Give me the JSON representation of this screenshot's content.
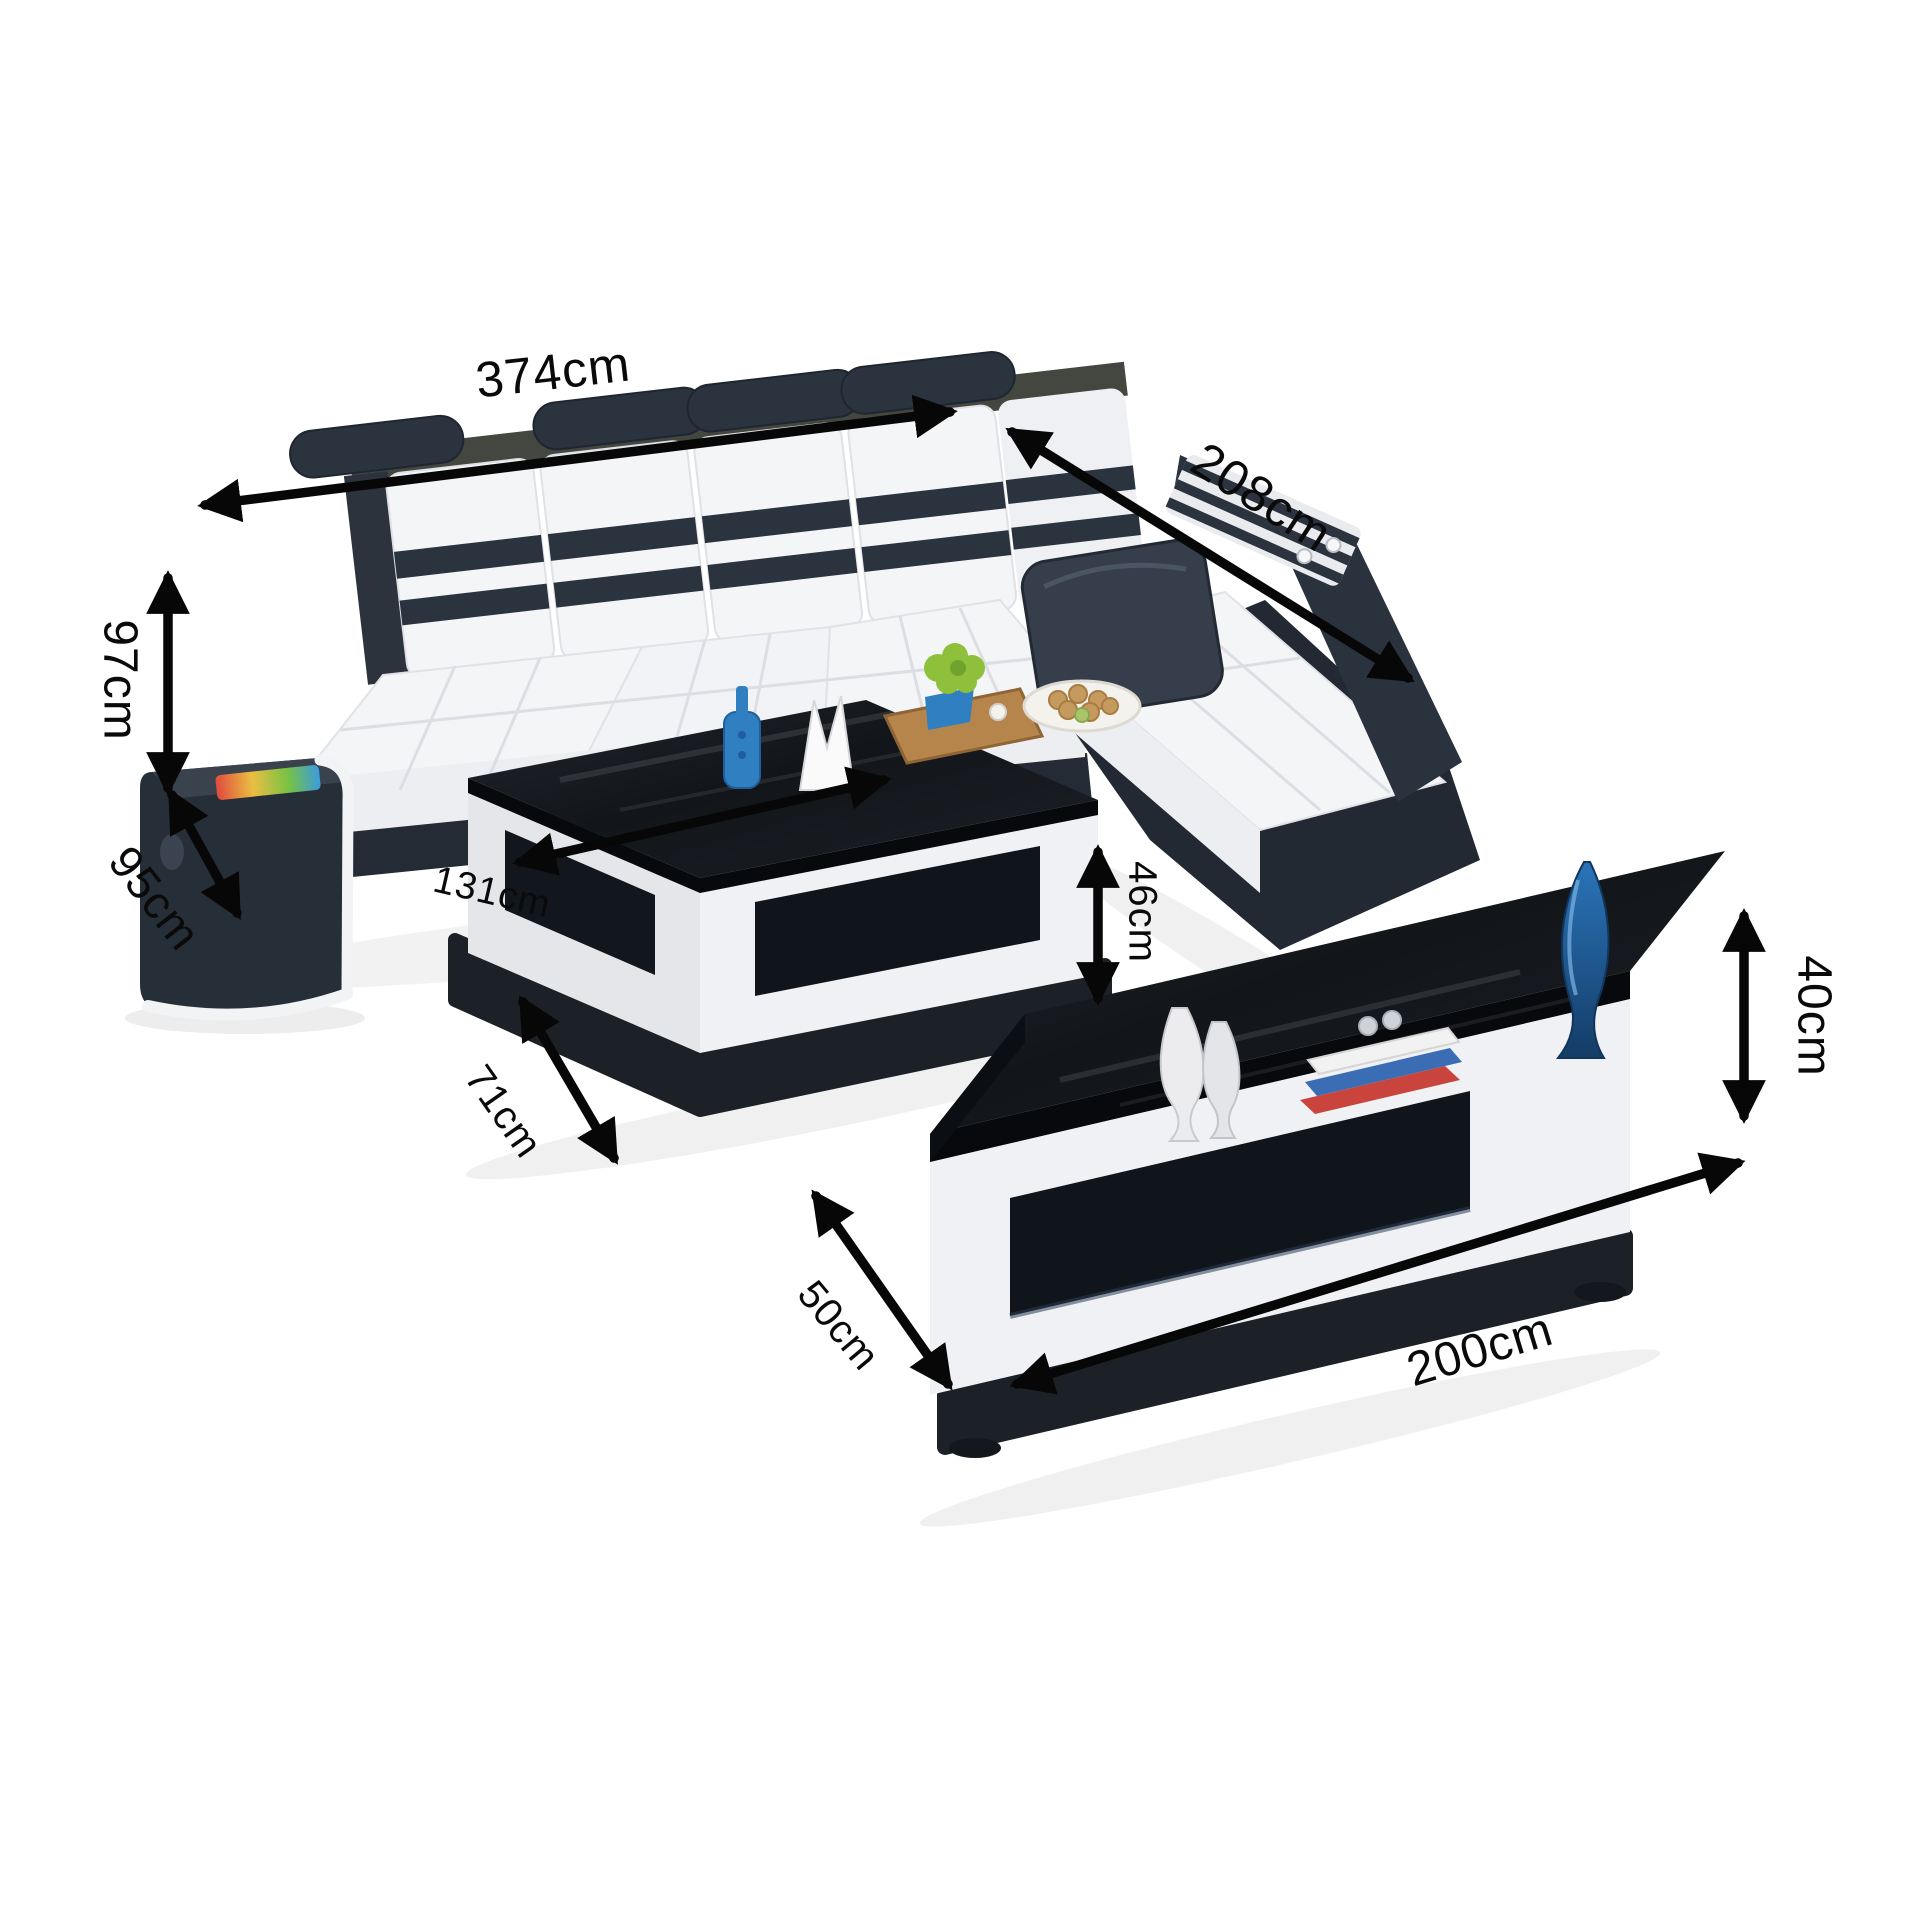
{
  "page": {
    "background": "#ffffff",
    "description": "Black and white living room furniture set dimension diagram: L-shaped sectional sofa, coffee table and TV stand with measurement arrows"
  },
  "palette": {
    "ink": "#0a0a0a",
    "sofa-dark": "#2b333f",
    "sofa-darker": "#1d242d",
    "rail-gray": "#43473f",
    "cushion-white": "#f4f5f7",
    "cushion-shade": "#e7e9ed",
    "glass-black": "#14171d",
    "glass-edge": "#07090d",
    "body-white": "#f0f1f4",
    "body-shade": "#e0e2e7",
    "plinth-black": "#1b2127",
    "accent-blue": "#2f7fc1",
    "deep-blue": "#1f5fa0",
    "plant-green": "#8fc03c",
    "wood-tan": "#b5854c",
    "cookie-tan": "#c59a5f"
  },
  "dimensions": {
    "sofa": {
      "length": "374cm",
      "chaise_depth": "208cm",
      "height": "97cm",
      "depth": "95cm"
    },
    "coffee_table": {
      "length": "131cm",
      "height": "46cm",
      "depth": "71cm"
    },
    "tv_stand": {
      "depth": "50cm",
      "height": "40cm",
      "length": "200cm"
    }
  }
}
